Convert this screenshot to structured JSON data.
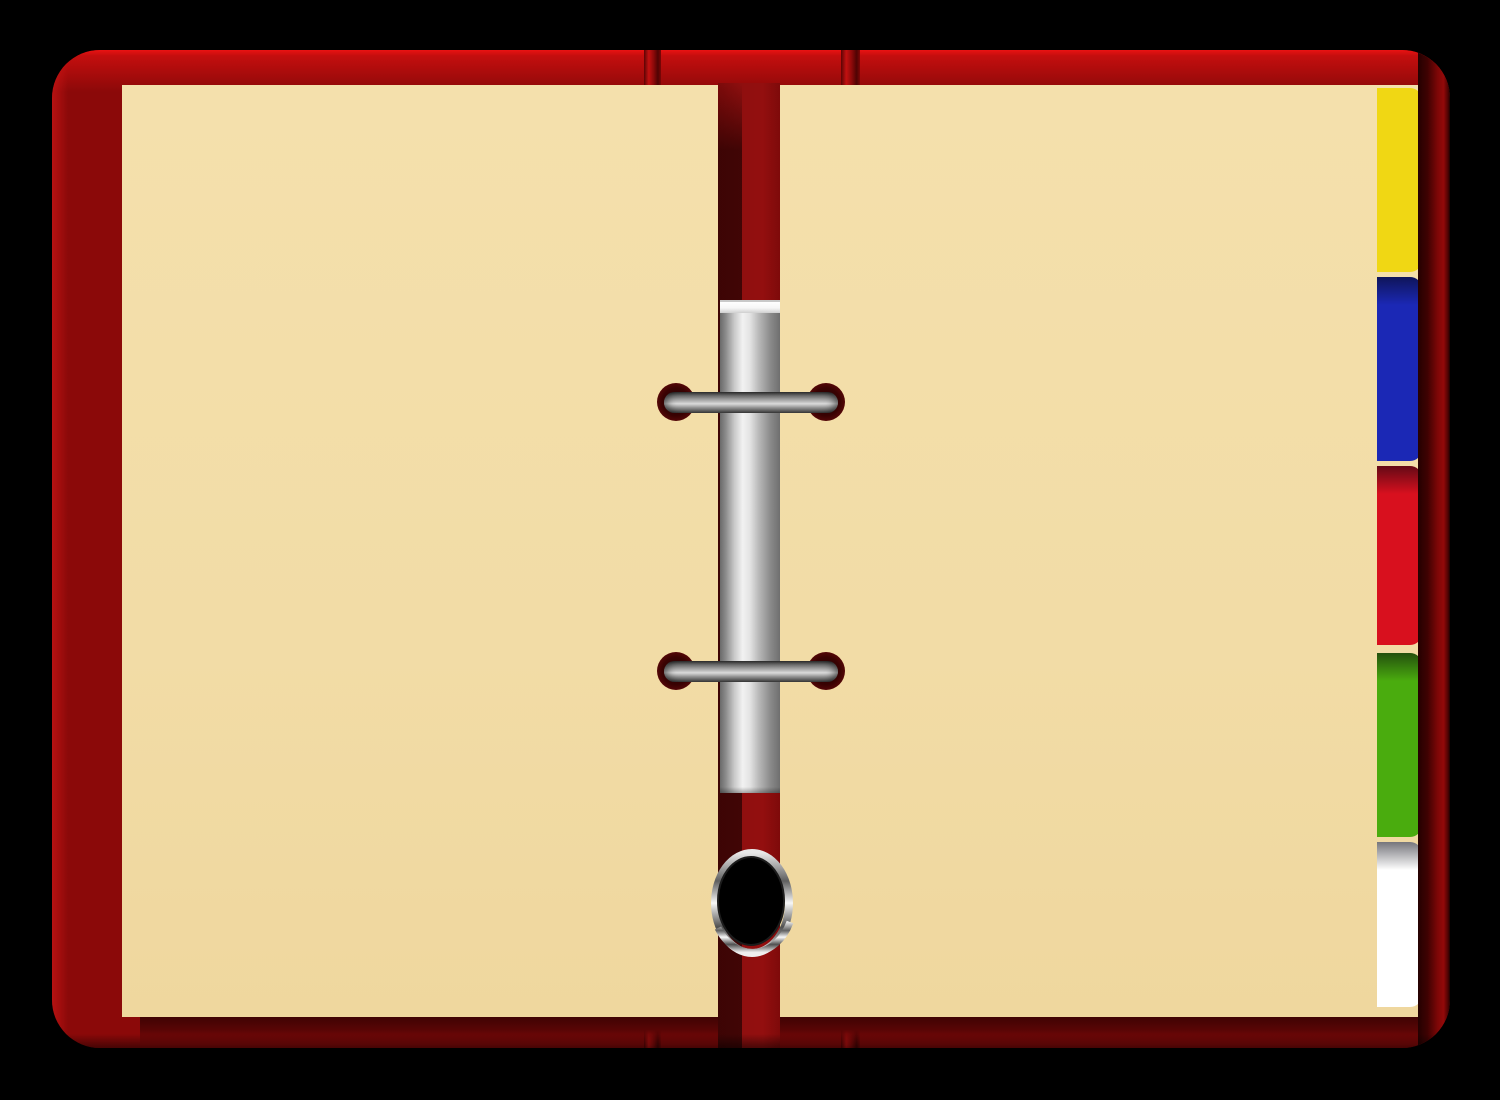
{
  "scene": {
    "subject": "open-ring-binder",
    "background_color": "#000000"
  },
  "binder": {
    "cover_color": "#8b0909",
    "cover_highlight_color": "#e91212",
    "spine_color": "#8f0f0f",
    "page_color": "#f2dca6",
    "metal_light_color": "#f2f2f2",
    "metal_dark_color": "#3c3c3c",
    "hole_color": "#3a0202",
    "pages": [
      {
        "side": "left"
      },
      {
        "side": "right"
      }
    ],
    "rings": [
      {
        "position": "upper"
      },
      {
        "position": "lower"
      }
    ],
    "bottom_ring": {
      "style": "chrome",
      "hole_color": "#000000"
    },
    "tabs": [
      {
        "name": "yellow",
        "color": "#f0d714"
      },
      {
        "name": "blue",
        "color": "#1b28b5"
      },
      {
        "name": "red",
        "color": "#d8101e"
      },
      {
        "name": "green",
        "color": "#4aac0e"
      },
      {
        "name": "white",
        "color": "#ffffff"
      }
    ]
  }
}
